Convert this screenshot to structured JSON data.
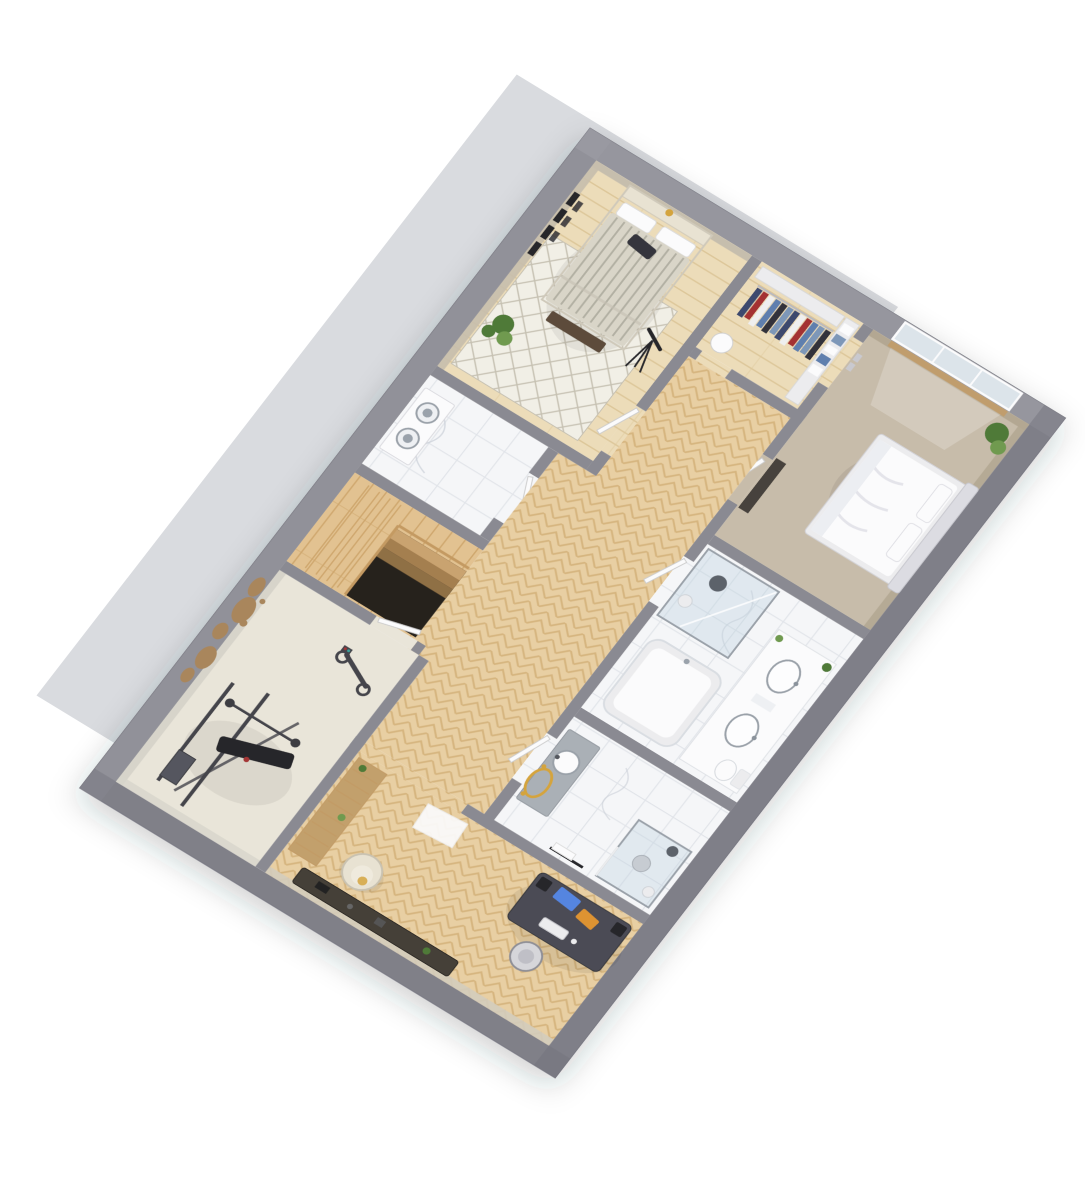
{
  "scene": {
    "type": "3d-floor-plan-render",
    "view": "rotated axonometric top-down dollhouse view, white background, pale backdrop slab behind plan",
    "rooms": [
      {
        "name": "bedroom-top",
        "floor": "light wood planks with white lattice rug",
        "furniture": [
          "double bed with striped grey duvet",
          "white pillows",
          "dark throw pillow",
          "foot bench",
          "potted plant",
          "telescope on tripod",
          "picture frames on wall",
          "wall lamp"
        ]
      },
      {
        "name": "walk-in-closet",
        "floor": "light wood",
        "furniture": [
          "clothes rail with hanging garments",
          "linen shelving",
          "round laundry hamper"
        ]
      },
      {
        "name": "bedroom-right",
        "floor": "taupe carpet",
        "furniture": [
          "double bed with white rumpled duvet",
          "fabric headboard",
          "pillows",
          "potted plant",
          "window with wooden sill",
          "wall switches",
          "dark cabinet"
        ]
      },
      {
        "name": "laundry-room",
        "floor": "white marble",
        "furniture": [
          "stacked washer and dryer column"
        ]
      },
      {
        "name": "hallway",
        "floor": "chevron parquet",
        "furniture": [
          "white interior doors"
        ]
      },
      {
        "name": "staircase",
        "floor": "wood planks",
        "furniture": [
          "descending stair flight",
          "dark stairwell void",
          "railing"
        ]
      },
      {
        "name": "bathroom",
        "floor": "white marble tile",
        "furniture": [
          "walk-in glass shower",
          "rain shower head",
          "shower stool",
          "bathtub",
          "double vanity with two basins",
          "toilet",
          "small plants"
        ]
      },
      {
        "name": "ensuite-shower-room",
        "floor": "white marble tile",
        "furniture": [
          "vanity with round basin",
          "gold oval mirror",
          "gold sconces",
          "towel rail",
          "corner glass shower",
          "stool"
        ]
      },
      {
        "name": "home-gym",
        "floor": "pale vinyl",
        "furniture": [
          "wooden world-map wall decor",
          "exercise bike",
          "multi-gym strength station",
          "weight bench",
          "barbell"
        ]
      },
      {
        "name": "home-office",
        "floor": "chevron parquet",
        "furniture": [
          "dark gaming desk",
          "monitor glowing blue",
          "monitor glowing orange",
          "speakers",
          "keyboard",
          "desk chair",
          "cream armchair",
          "low media console",
          "wooden slat shelf with plants",
          "white rug"
        ]
      }
    ]
  },
  "palette": {
    "slab": "#d9dbdf",
    "wall": "#8a8a92",
    "wall_dark": "#74747d",
    "wall_light": "#a2a2aa",
    "base_floor": "#f3f2ee",
    "wood": "#e8cfa3",
    "wood_line": "#d6b57f",
    "wood_dark": "#c29b66",
    "wood_pale": "#ecdcb9",
    "wood_pale_line": "#ddc79a",
    "plank": "#e2c291",
    "plank_line": "#cfa76e",
    "marble": "#f5f6f8",
    "marble_line": "#e1e4e9",
    "vein": "#c9cfd7",
    "rug": "#f1efe6",
    "rug_line": "#c6c1b2",
    "carpet": "#c7bcaa",
    "beige_wall": "#c6bead",
    "taupe_wall": "#b3a792",
    "gym_wall": "#d7d4ca",
    "cream_wall": "#d3ccbd",
    "gymfloor": "#e9e5d9",
    "glass": "#bcd2e0",
    "window_glass": "#dce4ea",
    "steel": "#9aa1a9",
    "counter": "#aab0b6",
    "white": "#fbfbfc",
    "softwhite": "#ececee",
    "duvet": "#d9d5c8",
    "stripe": "#a9a69a",
    "bench": "#5d4c3a",
    "cream": "#e8e2d2",
    "plant": "#4f7a38",
    "plant_light": "#6f9a50",
    "dark": "#44444c",
    "darker": "#26262c",
    "desk": "#4b4b54",
    "console": "#453f37",
    "cab_dark": "#46423c",
    "tan": "#c2a06c",
    "map": "#a9865c",
    "gold": "#d4a43e",
    "red": "#a43636",
    "screen_blue": "#5585e0",
    "screen_orange": "#dd9330",
    "void": "#27221b",
    "rail": "#c49a62",
    "c1": "#3c4a6e",
    "c2": "#5e7fae",
    "c3": "#a43333",
    "c4": "#efefef",
    "c5": "#32323a",
    "c6": "#7d97b8"
  }
}
